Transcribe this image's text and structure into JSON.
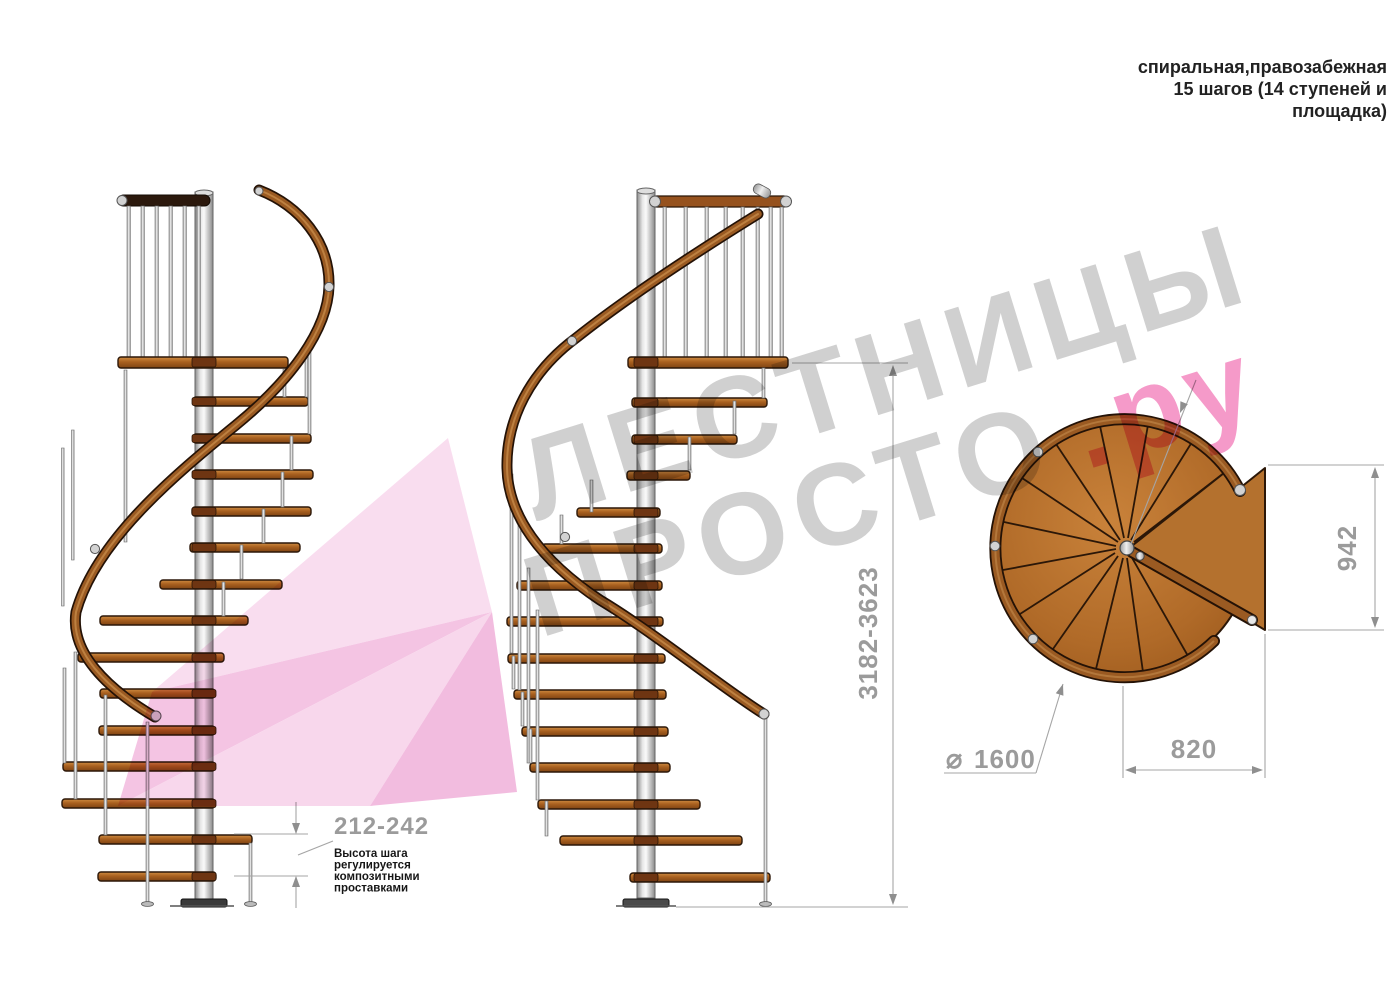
{
  "header": {
    "lines": [
      "спиральная,правозабежная",
      "15 шагов (14 ступеней и",
      "площадка)"
    ]
  },
  "watermark": {
    "word1": "ЛЕСТНИЦЫ",
    "word2": "ПРОСТО",
    "suffix": ".ру",
    "gray": "#cbcbcb",
    "pink": "#f48fc3"
  },
  "dimensions": {
    "total_height": "3182-3623",
    "step_height": "212-242",
    "step_note_lines": [
      "Высота шага",
      "регулируется",
      "композитными",
      "проставками"
    ],
    "landing_depth": "942",
    "landing_width": "820",
    "diameter_symbol": "⌀",
    "diameter_value": "1600"
  },
  "colors": {
    "dimension_gray": "#9b9b9b",
    "annotation_black": "#161616",
    "tread_wood": "#a9601f",
    "rail_wood": "#9a5a22",
    "metal": "#c6c6c6"
  }
}
